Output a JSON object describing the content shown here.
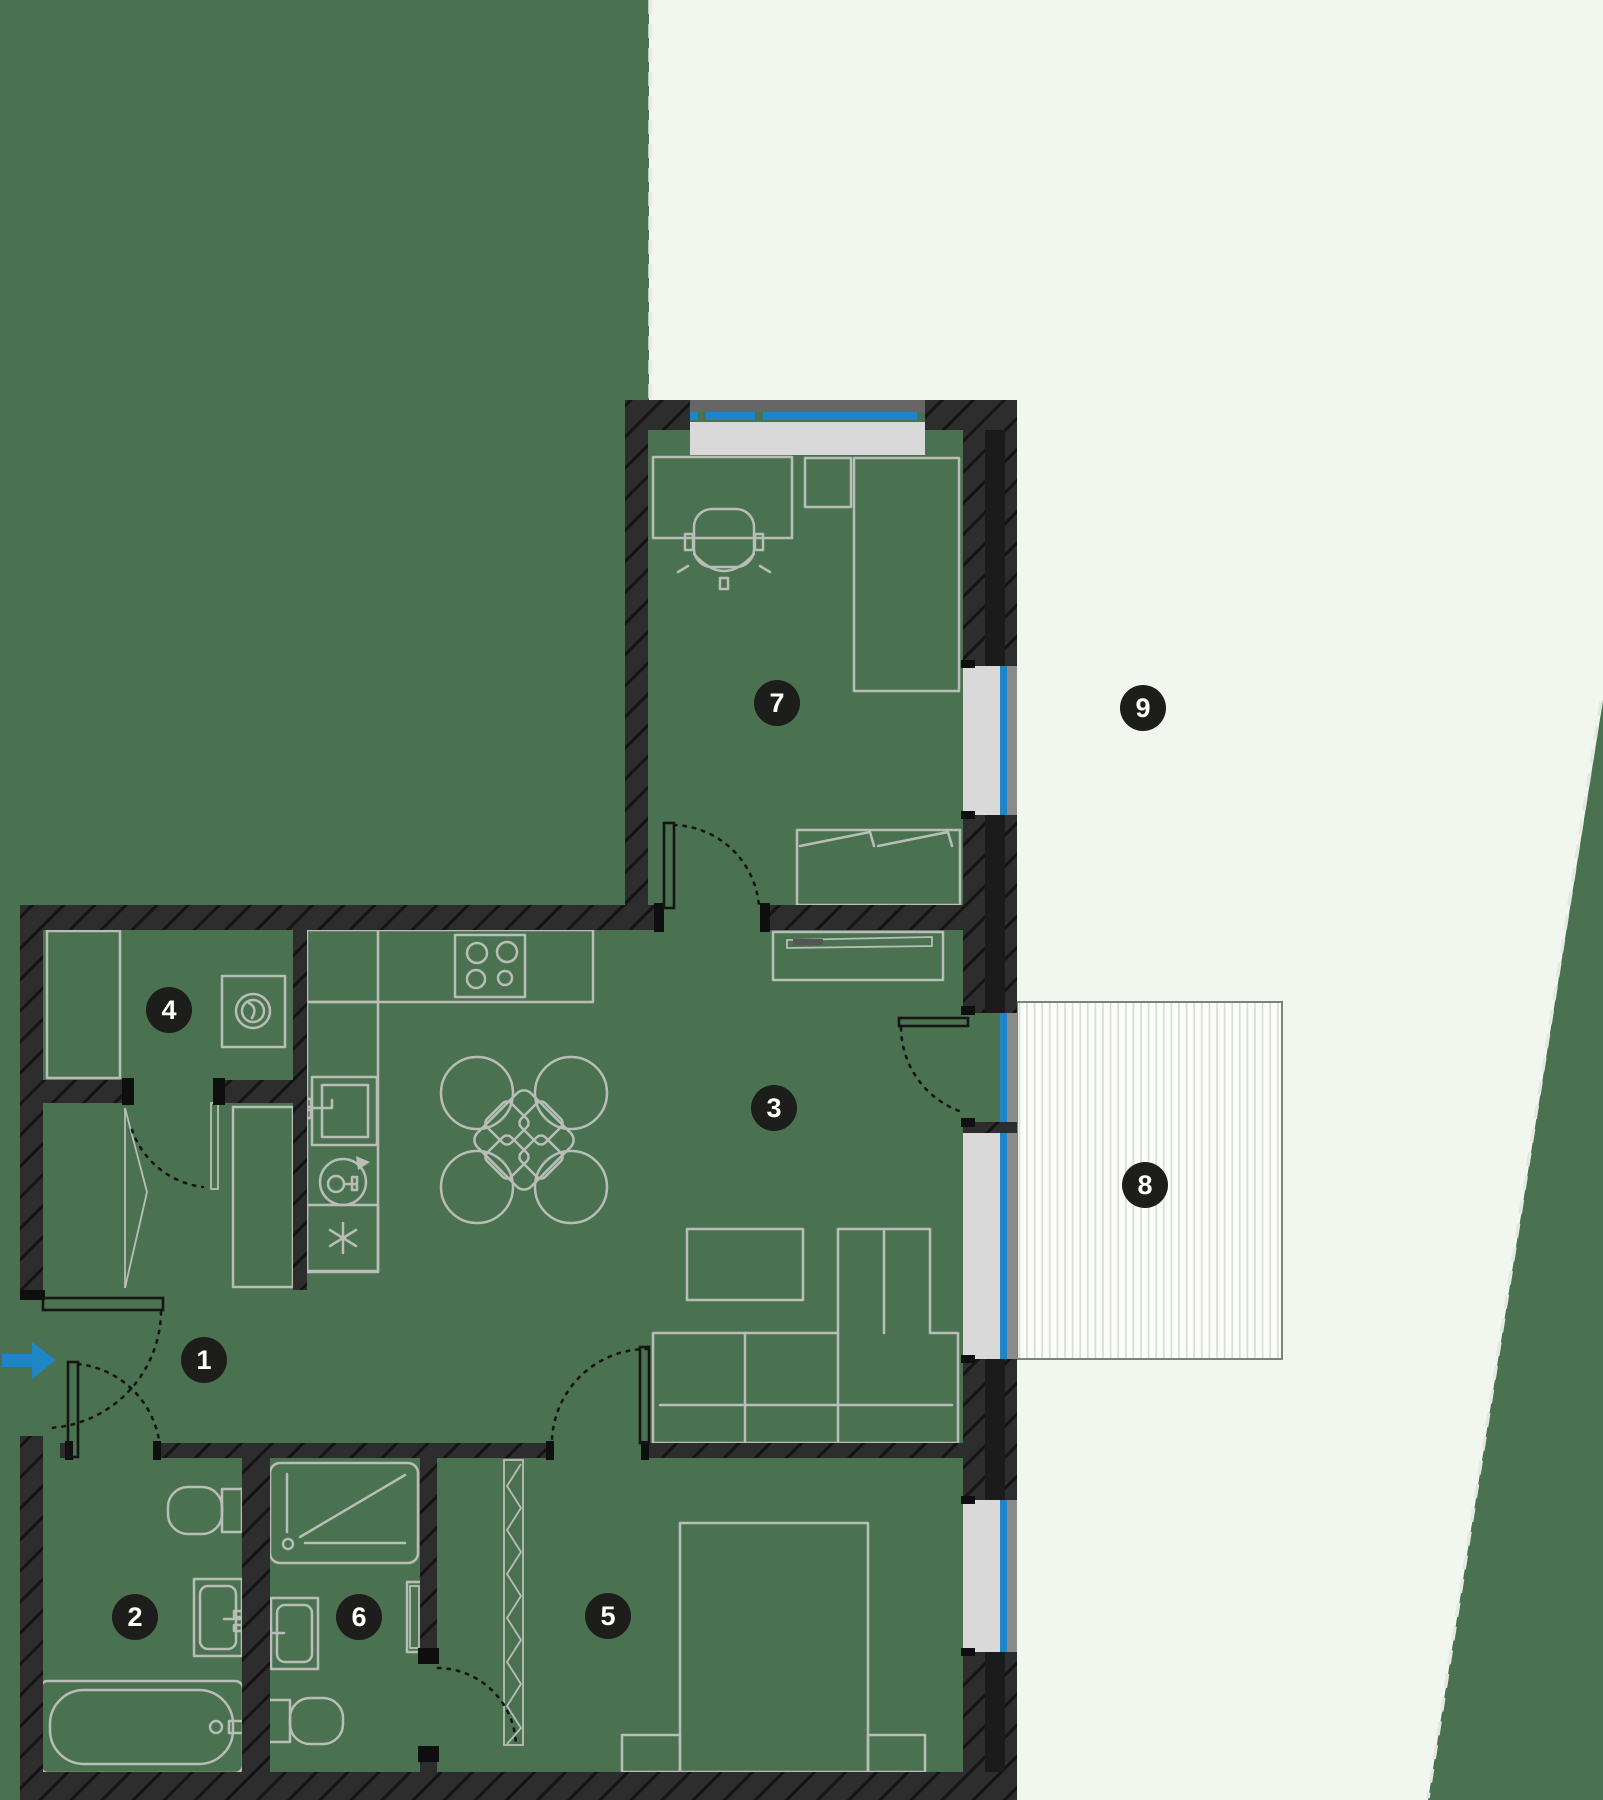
{
  "floorplan": {
    "badges": [
      {
        "label": "1",
        "x": 204,
        "y": 1360
      },
      {
        "label": "2",
        "x": 135,
        "y": 1617
      },
      {
        "label": "3",
        "x": 774,
        "y": 1108
      },
      {
        "label": "4",
        "x": 169,
        "y": 1010
      },
      {
        "label": "5",
        "x": 608,
        "y": 1616
      },
      {
        "label": "6",
        "x": 359,
        "y": 1617
      },
      {
        "label": "7",
        "x": 777,
        "y": 703
      },
      {
        "label": "8",
        "x": 1145,
        "y": 1185
      },
      {
        "label": "9",
        "x": 1143,
        "y": 708
      }
    ],
    "palette": {
      "background": "#4a7250",
      "garden": "#f1f6ee",
      "wall": "#2d2d2d",
      "wall_dark": "#1b1b1b",
      "fixture": "#b9bdb7",
      "glass": "#1d86c8",
      "sill": "#d9d9d9",
      "frame": "#8b8b8b",
      "terrace_fill": "#fbfdfa",
      "terrace_stripe": "#d6dbd3",
      "badge_bg": "#1d1d1b",
      "badge_text": "#ffffff",
      "arrow": "#1f86c5",
      "dash": "#e3e8e0"
    },
    "entrance_arrow": {
      "direction": "right"
    }
  }
}
